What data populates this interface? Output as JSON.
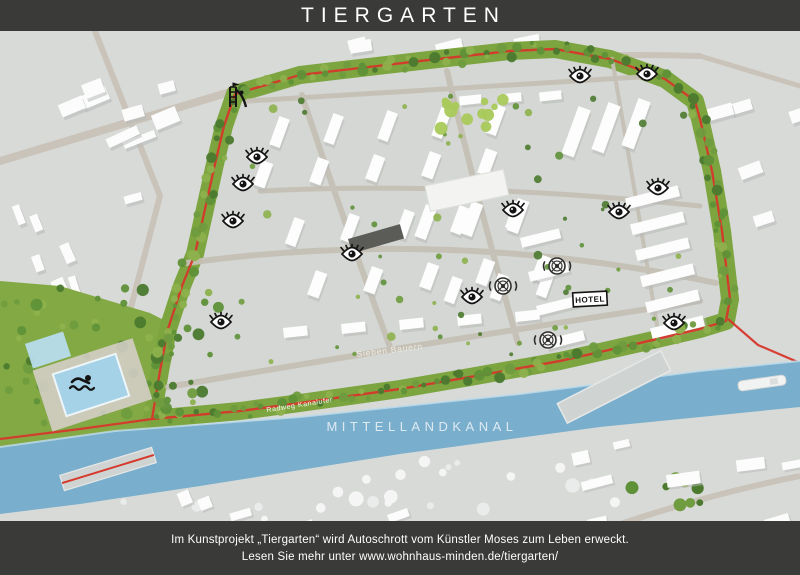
{
  "header": {
    "title": "TIERGARTEN"
  },
  "footer": {
    "line1": "Im Kunstprojekt „Tiergarten“ wird Autoschrott vom Künstler Moses zum Leben erweckt.",
    "line2": "Lesen Sie mehr unter www.wohnhaus-minden.de/tiergarten/"
  },
  "map": {
    "labels": {
      "canal": "MITTELLANDKANAL",
      "bike_path": "Radweg Kanalufer",
      "street": "Sieben Bauern",
      "hotel": "HOTEL"
    },
    "colors": {
      "header_bg": "#3a3a38",
      "canal_blue": "#79aecd",
      "path_red": "#d6382c",
      "greenbelt_green": "#6f9c3e",
      "ground_gray": "#d8dad7"
    },
    "markers": [
      {
        "type": "tower",
        "name": "lookout-tower-icon",
        "x": 237,
        "y": 65
      },
      {
        "type": "eye",
        "name": "eye-icon",
        "x": 257,
        "y": 126
      },
      {
        "type": "eye",
        "name": "eye-icon",
        "x": 243,
        "y": 153
      },
      {
        "type": "eye",
        "name": "eye-icon",
        "x": 233,
        "y": 190
      },
      {
        "type": "eye",
        "name": "eye-icon",
        "x": 352,
        "y": 223
      },
      {
        "type": "eye",
        "name": "eye-icon",
        "x": 221,
        "y": 291
      },
      {
        "type": "eye",
        "name": "eye-icon",
        "x": 580,
        "y": 45
      },
      {
        "type": "eye",
        "name": "eye-icon",
        "x": 647,
        "y": 43
      },
      {
        "type": "eye",
        "name": "eye-icon",
        "x": 658,
        "y": 157
      },
      {
        "type": "eye",
        "name": "eye-icon",
        "x": 619,
        "y": 181
      },
      {
        "type": "eye",
        "name": "eye-icon",
        "x": 674,
        "y": 292
      },
      {
        "type": "eye",
        "name": "eye-icon",
        "x": 472,
        "y": 266
      },
      {
        "type": "eye",
        "name": "eye-icon",
        "x": 513,
        "y": 179
      },
      {
        "type": "wheel",
        "name": "wheel-eye-icon",
        "x": 557,
        "y": 235
      },
      {
        "type": "wheel",
        "name": "wheel-eye-icon",
        "x": 503,
        "y": 255
      },
      {
        "type": "wheel",
        "name": "wheel-eye-icon",
        "x": 548,
        "y": 309
      },
      {
        "type": "swimmer",
        "name": "swimmer-icon",
        "x": 82,
        "y": 352
      },
      {
        "type": "hotel",
        "name": "hotel-label",
        "x": 590,
        "y": 268,
        "label_key": "hotel"
      }
    ]
  }
}
